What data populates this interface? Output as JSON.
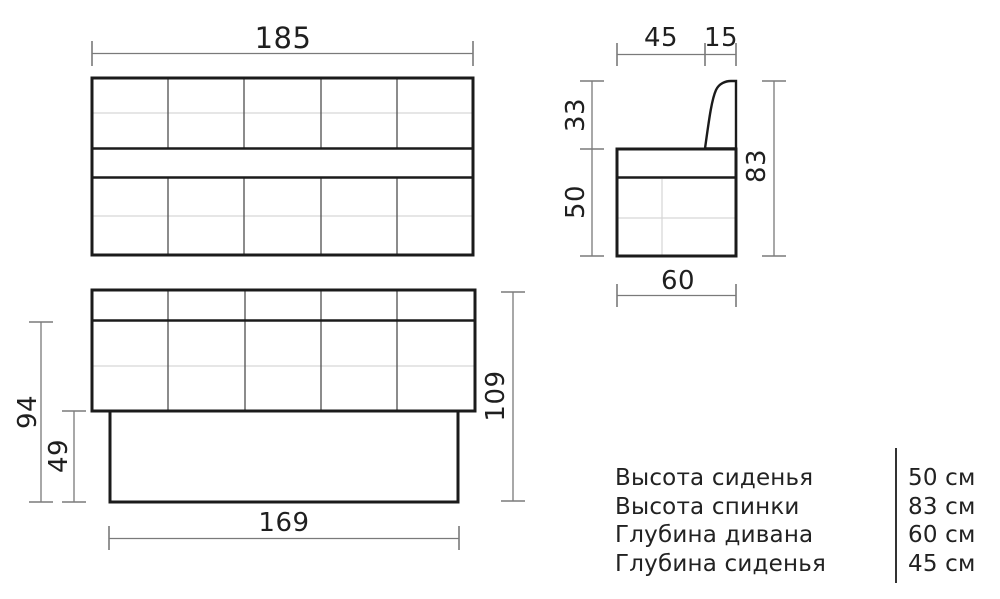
{
  "drawing": {
    "front_view": {
      "width_dim": "185"
    },
    "side_view": {
      "seat_depth_dim": "45",
      "backrest_thickness_dim": "15",
      "backrest_above_seat_dim": "33",
      "seat_height_dim": "50",
      "total_height_dim": "83",
      "total_depth_dim": "60"
    },
    "lower_view": {
      "upper_height_dim": "94",
      "base_height_dim": "49",
      "total_height_dim": "109",
      "base_width_dim": "169"
    }
  },
  "specs": {
    "rows": [
      {
        "label": "Высота сиденья",
        "value": "50 см"
      },
      {
        "label": "Высота спинки",
        "value": "83 см"
      },
      {
        "label": "Глубина дивана",
        "value": "60 см"
      },
      {
        "label": "Глубина сиденья",
        "value": "45 см"
      }
    ]
  },
  "colors": {
    "background": "#ffffff",
    "line_dark": "#1b1b1b",
    "line_medium": "#5a5a5a",
    "line_light": "#d6d6d6",
    "line_dimension": "#7a7a7a",
    "text": "#1f1f1f"
  }
}
